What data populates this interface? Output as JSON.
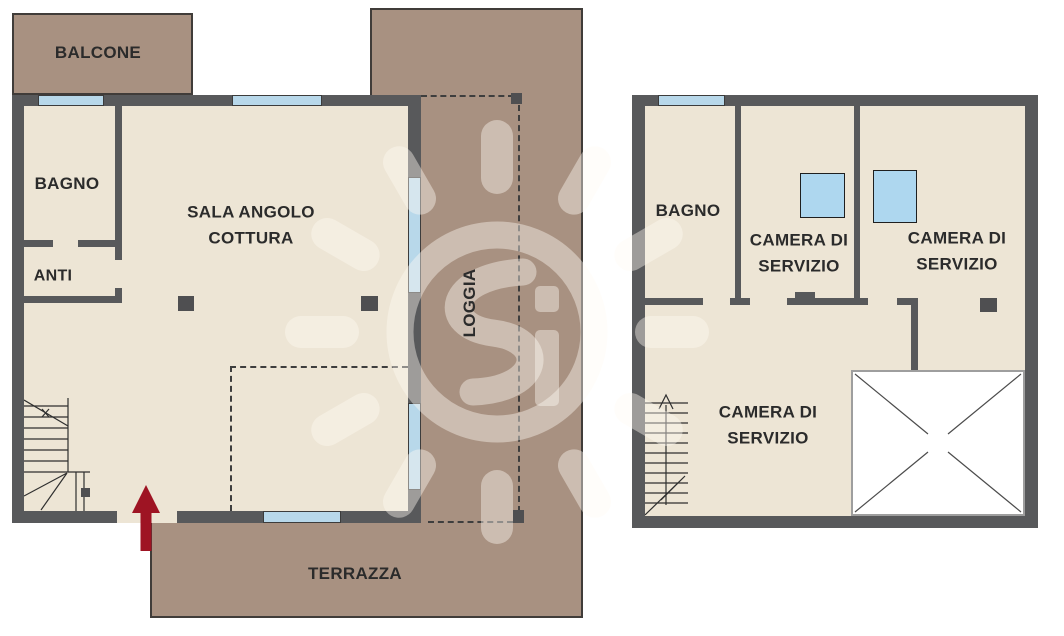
{
  "left_plan": {
    "balcone_label": "BALCONE",
    "bagno_label": "BAGNO",
    "anti_label": "ANTI",
    "sala_label": "SALA ANGOLO\nCOTTURA",
    "loggia_label": "LOGGIA",
    "terrazza_label": "TERRAZZA"
  },
  "right_plan": {
    "bagno_label": "BAGNO",
    "camera_servizio_1_label": "CAMERA DI\nSERVIZIO",
    "camera_servizio_2_label": "CAMERA DI\nSERVIZIO",
    "camera_servizio_3_label": "CAMERA DI\nSERVIZIO"
  },
  "colors": {
    "wall": "#58595b",
    "interior": "#ede5d5",
    "outdoor": "#a89181",
    "window": "#b8d8ea",
    "skylight": "#aed7ef",
    "entrance_arrow": "#9e1423",
    "void": "#ffffff"
  }
}
